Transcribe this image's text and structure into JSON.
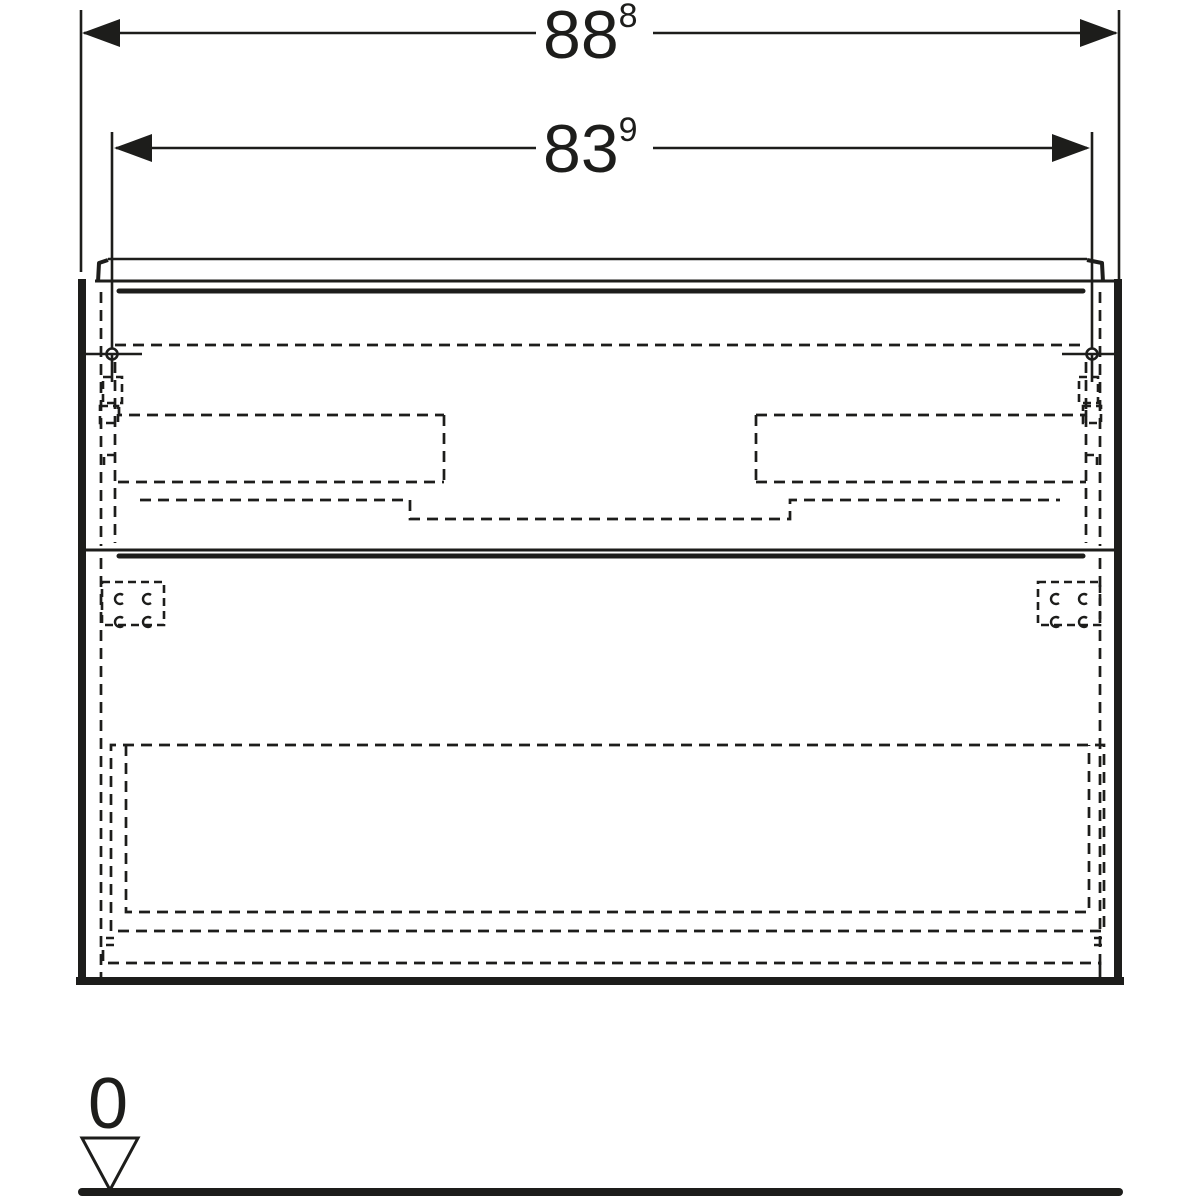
{
  "colors": {
    "line": "#1d1d1b",
    "background": "#ffffff"
  },
  "dimensions": {
    "overall_width": {
      "value": "88",
      "superscript": "8"
    },
    "fixing_width": {
      "value": "83",
      "superscript": "9"
    }
  },
  "datum": {
    "label": "0"
  }
}
